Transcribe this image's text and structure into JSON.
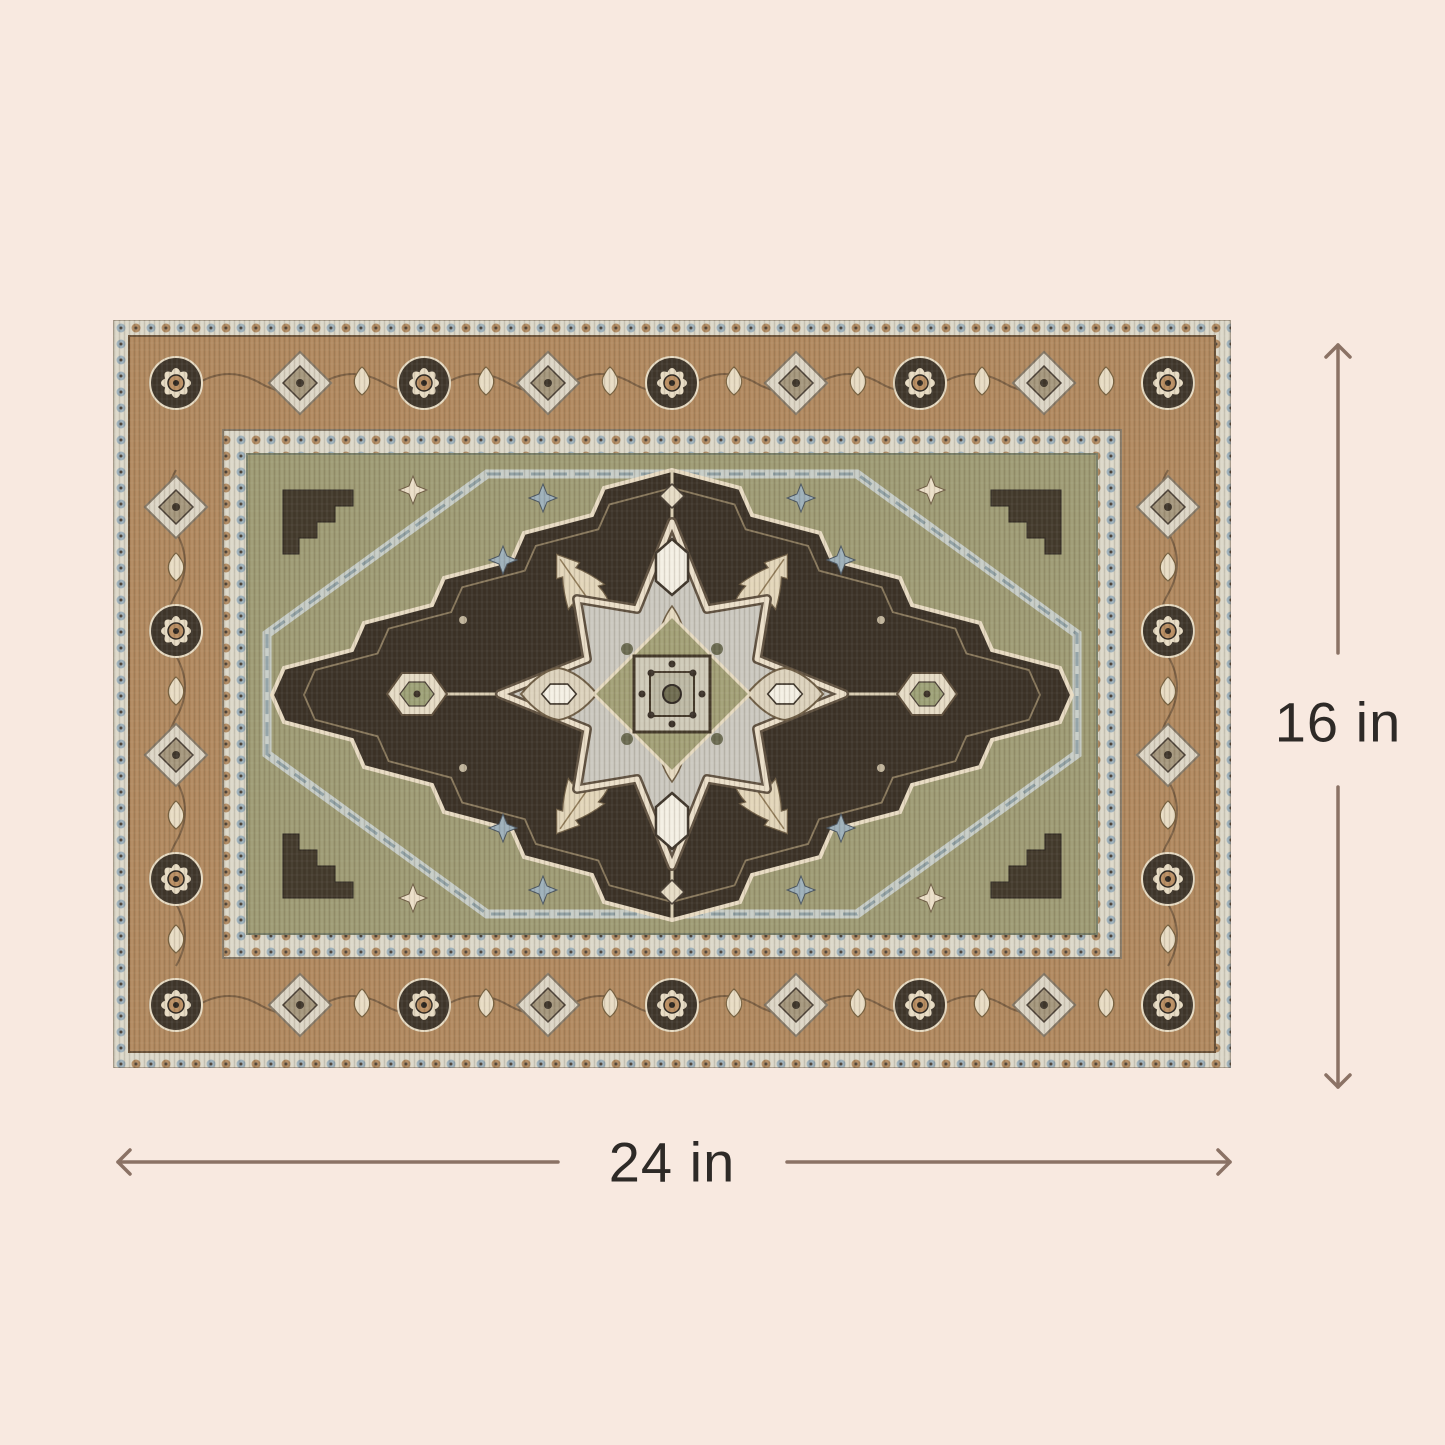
{
  "title": "Rug dimension diagram",
  "background_color": "#f8e9e0",
  "dimension_annotations": {
    "line_color": "#8b7265",
    "text_color": "#2e2a27",
    "height": {
      "label": "16 in",
      "start_icon": "arrow-up-icon",
      "end_icon": "arrow-down-icon"
    },
    "width": {
      "label": "24 in",
      "start_icon": "arrow-left-icon",
      "end_icon": "arrow-right-icon"
    }
  },
  "rug": {
    "style": "persian-heriz-medallion",
    "palette": {
      "border_tan": "#b1895f",
      "field_olive": "#9e9b74",
      "dark_brown": "#3b3227",
      "cream": "#e9dcc4",
      "medallion_gray": "#cbc8bf",
      "guard_light": "#dcd8c9",
      "accent_blue": "#9db0ba"
    }
  }
}
